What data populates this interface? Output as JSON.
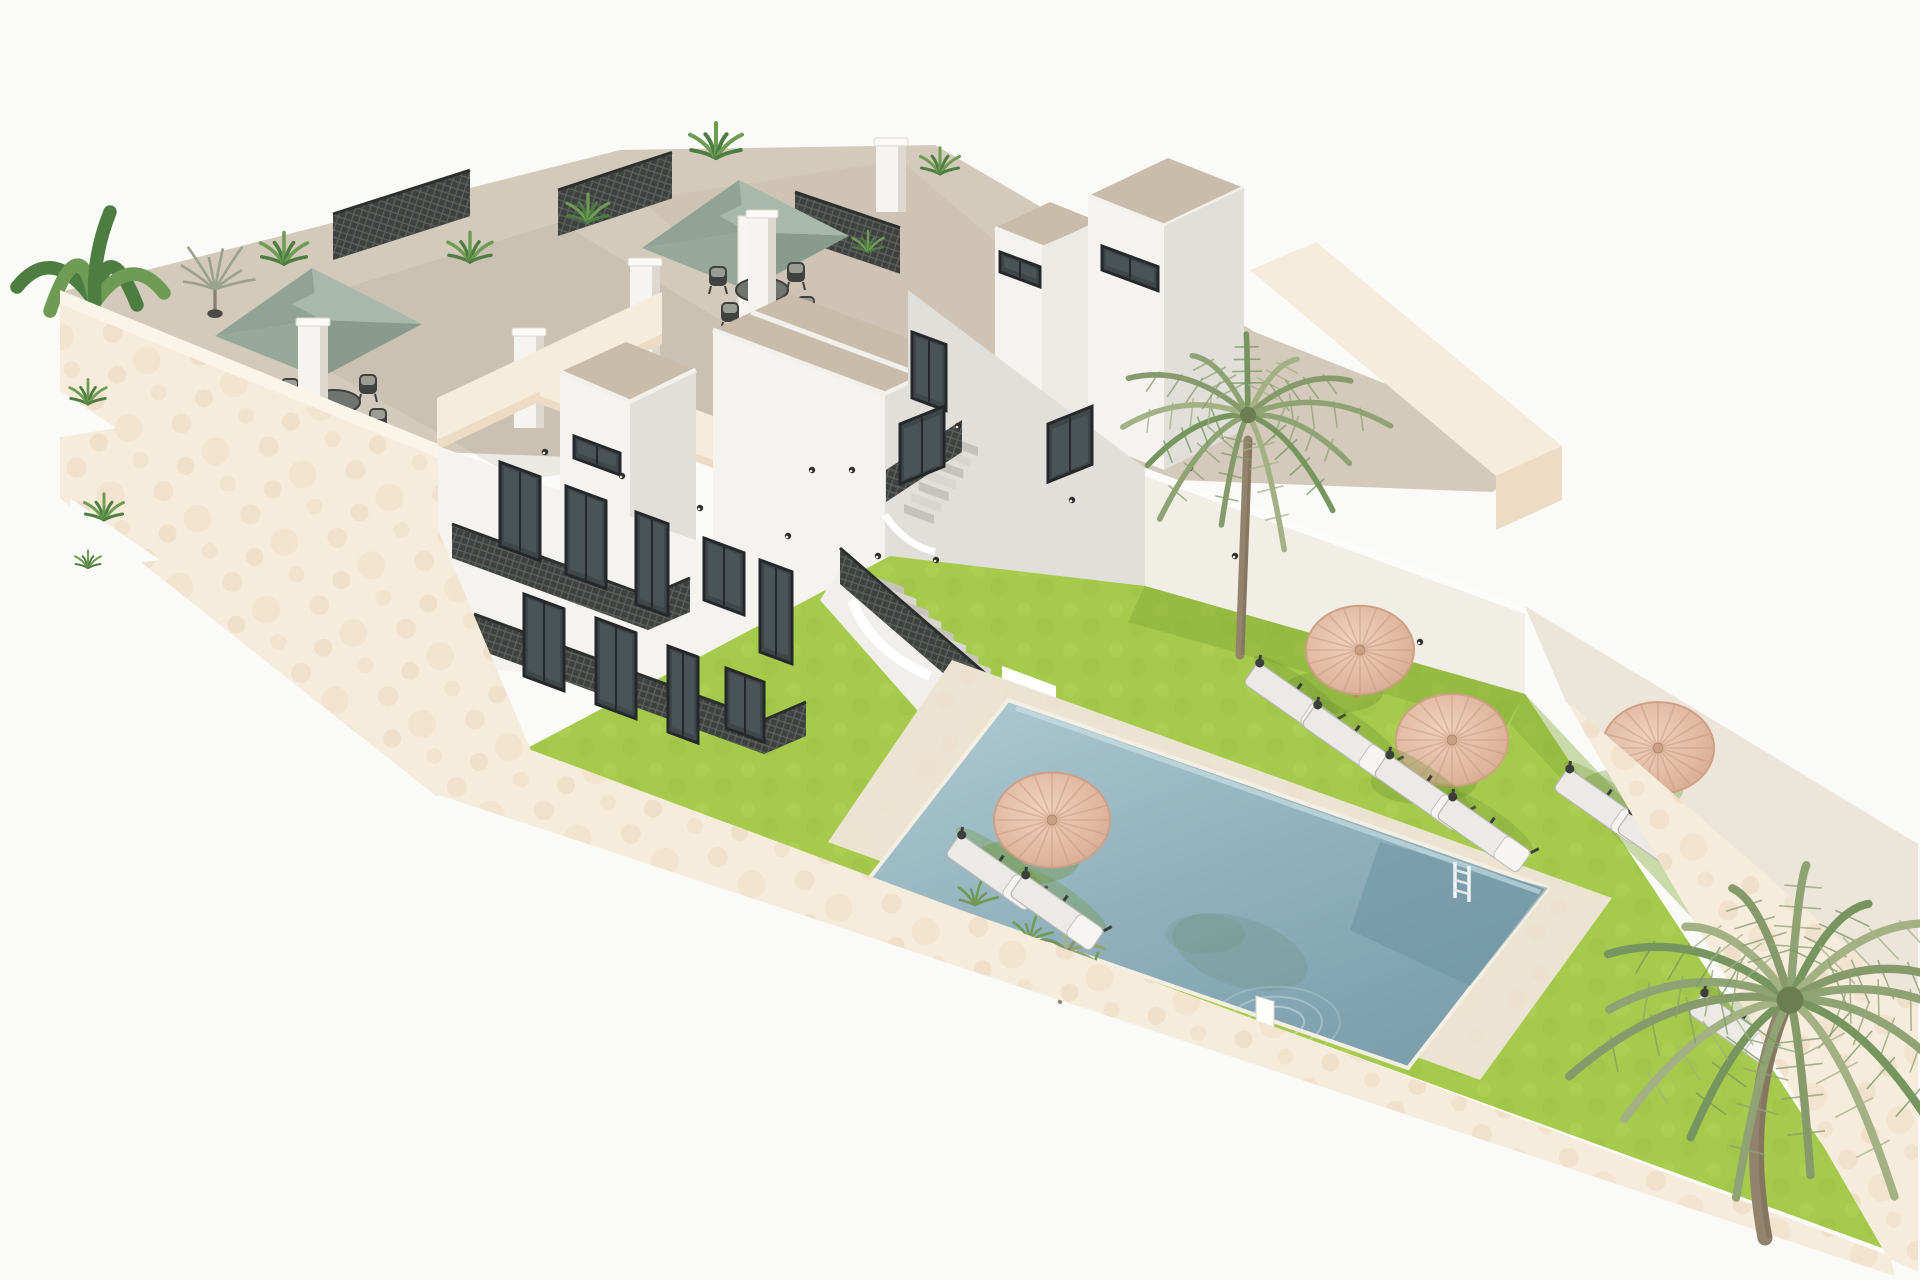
{
  "scene": {
    "type": "3d-architectural-render",
    "description": "Aerial 3D render of a white Mediterranean residential building with two roof terraces, cream perimeter walls, green lawn garden, rectangular swimming pool, straw parasols, sun loungers and palm trees on a white background.",
    "background": "#fafaf8"
  },
  "palette": {
    "cream": "#f6ecdc",
    "cream_shade": "#eddcc3",
    "cream_deep": "#e7d2b8",
    "white_lit": "#f4f3f0",
    "white_mid": "#eceae5",
    "white_shade": "#e1dfd9",
    "white_deep": "#d5d3cd",
    "roof_tan": "#c9bcab",
    "floor_tan": "#d4cabc",
    "floor_shadow": "#a79c8c",
    "lattice": "#3e413f",
    "lattice_line": "#5d615d",
    "grass": "#a6ca4c",
    "grass_light": "#b7d75f",
    "grass_shade": "#85ab38",
    "deck": "#ece4d3",
    "water_1": "#adc9d2",
    "water_2": "#7d9fae",
    "water_deep": "#6d93a2",
    "thatch": "#e4bfa9",
    "thatch_dark": "#cf9f86",
    "thatch_line": "#c9997e",
    "sage_1": "#a8b9ab",
    "sage_2": "#97a99b",
    "sage_3": "#899b8d",
    "sage_4": "#91a395",
    "plant": "#6f9c54",
    "plant_dark": "#4e7d42",
    "plant_pale": "#9aa38e",
    "palm": "#8fa374",
    "palm_dark": "#77965f",
    "trunk": "#93836c",
    "glass": "#3f4648",
    "frame": "#24282a",
    "step": "#d9d6cf",
    "step_dark": "#c6c3bc",
    "rail_top": "#2c2f2d",
    "chair_dark": "#3f4240",
    "cushion": "#9b9c94",
    "pole_wood": "#b98c55"
  },
  "objects": {
    "roof_terraces": 2,
    "green_parasols": 2,
    "dining_sets": 2,
    "thatch_parasols": 4,
    "sun_loungers": 9,
    "palm_trees": 3,
    "pools": 1
  },
  "roof_terraces": {
    "fences": [
      [
        333,
        214,
        137,
        46,
        -0.32
      ],
      [
        558,
        190,
        114,
        46,
        -0.33
      ],
      [
        795,
        192,
        105,
        46,
        0.34
      ]
    ],
    "parasols": [
      {
        "cx": 318,
        "cy": 316,
        "table": [
          334,
          402
        ],
        "mast": [
          312,
          318,
          14,
          112
        ]
      },
      {
        "cx": 745,
        "cy": 228,
        "table": [
          762,
          290
        ],
        "mast": [
          738,
          216,
          14,
          104
        ]
      }
    ]
  },
  "building": {
    "chimneys": [
      [
        298,
        322,
        30,
        108
      ],
      [
        514,
        332,
        30,
        96
      ],
      [
        482,
        540,
        34,
        116
      ],
      [
        630,
        262,
        30,
        146
      ],
      [
        748,
        214,
        28,
        112
      ],
      [
        876,
        142,
        30,
        70
      ]
    ],
    "windows": [
      [
        500,
        462,
        40,
        84,
        0.37
      ],
      [
        566,
        486,
        40,
        88,
        0.37
      ],
      [
        636,
        512,
        32,
        92,
        0.37
      ],
      [
        704,
        538,
        40,
        62,
        0.37
      ],
      [
        760,
        560,
        32,
        92,
        0.37
      ],
      [
        524,
        594,
        40,
        82,
        0.37
      ],
      [
        596,
        618,
        40,
        86,
        0.37
      ],
      [
        668,
        646,
        30,
        86,
        0.37
      ],
      [
        726,
        668,
        38,
        60,
        0.37
      ],
      [
        574,
        436,
        46,
        22,
        0.37
      ],
      [
        912,
        332,
        34,
        66,
        0.37
      ],
      [
        1000,
        252,
        40,
        20,
        0.37
      ],
      [
        1048,
        424,
        44,
        58,
        -0.4
      ],
      [
        1102,
        246,
        56,
        24,
        0.37
      ],
      [
        900,
        424,
        44,
        60,
        -0.4
      ]
    ],
    "sconces": [
      [
        545,
        452
      ],
      [
        622,
        476
      ],
      [
        700,
        508
      ],
      [
        788,
        536
      ],
      [
        852,
        470
      ],
      [
        878,
        556
      ],
      [
        958,
        426
      ],
      [
        1072,
        500
      ],
      [
        1190,
        468
      ],
      [
        1235,
        556
      ],
      [
        1420,
        642
      ],
      [
        1658,
        806
      ],
      [
        936,
        560
      ],
      [
        812,
        470
      ]
    ],
    "stairs": [
      {
        "x1": 868,
        "y1": 574,
        "x2": 992,
        "y2": 690,
        "n": 11,
        "w": 36
      },
      {
        "x1": 948,
        "y1": 436,
        "x2": 904,
        "y2": 504,
        "n": 7,
        "w": 30
      }
    ]
  },
  "garden": {
    "parasols": [
      [
        1360,
        650,
        54
      ],
      [
        1452,
        740,
        56
      ],
      [
        1052,
        820,
        58
      ],
      [
        1658,
        748,
        56
      ]
    ],
    "loungers": [
      [
        1290,
        700
      ],
      [
        1348,
        742
      ],
      [
        1420,
        792
      ],
      [
        1483,
        834
      ],
      [
        992,
        872
      ],
      [
        1056,
        912
      ],
      [
        1600,
        806
      ],
      [
        1663,
        848
      ],
      [
        1735,
        1030
      ]
    ],
    "pool": {
      "deck": [
        [
          952,
          660
        ],
        [
          1612,
          898
        ],
        [
          1480,
          1080
        ],
        [
          828,
          842
        ]
      ],
      "water": [
        [
          1008,
          700
        ],
        [
          1548,
          888
        ],
        [
          1408,
          1068
        ],
        [
          868,
          880
        ]
      ],
      "dark_patch": [
        [
          1380,
          842
        ],
        [
          1548,
          888
        ],
        [
          1470,
          986
        ],
        [
          1350,
          930
        ]
      ],
      "ladder": [
        1455,
        876
      ],
      "ledge": [
        1256,
        996
      ],
      "ripple": [
        1276,
        1022
      ],
      "reflection": [
        1240,
        952
      ],
      "edge_plants": [
        [
          975,
          905
        ],
        [
          1030,
          940
        ],
        [
          1092,
          976
        ],
        [
          1162,
          1012
        ],
        [
          1232,
          1048
        ]
      ]
    }
  },
  "vegetation": {
    "palms": [
      {
        "cx": 1248,
        "cy": 415,
        "r": 150,
        "n": 13,
        "tw": 9,
        "trunk": [
          [
            1240,
            655
          ],
          [
            1244,
            545
          ],
          [
            1248,
            440
          ]
        ],
        "layer": "mid"
      },
      {
        "cx": 1790,
        "cy": 1000,
        "r": 235,
        "n": 17,
        "tw": 15,
        "trunk": [
          [
            1765,
            1238
          ],
          [
            1742,
            1115
          ],
          [
            1782,
            1012
          ]
        ],
        "layer": "front"
      },
      {
        "cx": 1068,
        "cy": 952,
        "r": 50,
        "n": 9,
        "tw": 4,
        "trunk": [
          [
            1060,
            1002
          ],
          [
            1063,
            978
          ],
          [
            1068,
            956
          ]
        ],
        "layer": "deck"
      }
    ],
    "plants": [
      [
        95,
        302,
        1.5,
        "banana",
        "terrace"
      ],
      [
        215,
        296,
        1.1,
        "pale",
        "terrace"
      ],
      [
        284,
        264,
        0.9,
        "fern",
        "terrace"
      ],
      [
        470,
        262,
        0.85,
        "fern",
        "terrace"
      ],
      [
        588,
        222,
        0.8,
        "fern",
        "terrace"
      ],
      [
        716,
        158,
        1.0,
        "fern",
        "terrace"
      ],
      [
        940,
        174,
        0.75,
        "fern",
        "terrace"
      ],
      [
        868,
        252,
        0.6,
        "fern",
        "terrace"
      ],
      [
        88,
        404,
        0.7,
        "fern",
        "front"
      ],
      [
        104,
        520,
        0.75,
        "fern",
        "front"
      ],
      [
        88,
        568,
        0.5,
        "fern",
        "front"
      ]
    ]
  }
}
